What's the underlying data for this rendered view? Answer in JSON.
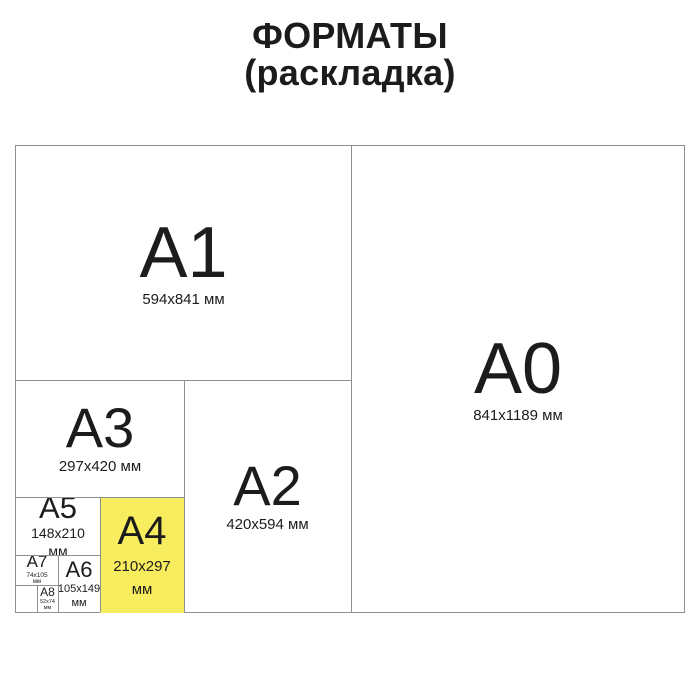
{
  "title": {
    "line1": "ФОРМАТЫ",
    "line2": "(раскладка)"
  },
  "formats": {
    "a0": {
      "name": "A0",
      "dims": "841x1189 мм"
    },
    "a1": {
      "name": "A1",
      "dims": "594x841 мм"
    },
    "a2": {
      "name": "A2",
      "dims": "420x594 мм"
    },
    "a3": {
      "name": "A3",
      "dims": "297x420 мм"
    },
    "a4": {
      "name": "A4",
      "dims": "210x297",
      "unit": "мм",
      "highlighted": true
    },
    "a5": {
      "name": "A5",
      "dims": "148x210",
      "unit": "мм"
    },
    "a6": {
      "name": "A6",
      "dims": "105x149",
      "unit": "мм"
    },
    "a7": {
      "name": "A7",
      "dims": "74x105",
      "unit": "мм"
    },
    "a8": {
      "name": "A8",
      "dims": "52x74",
      "unit": "мм"
    }
  },
  "colors": {
    "highlight": "#f7ed5e",
    "border": "#8f8f8f",
    "text": "#1c1c1c",
    "background": "#ffffff"
  }
}
